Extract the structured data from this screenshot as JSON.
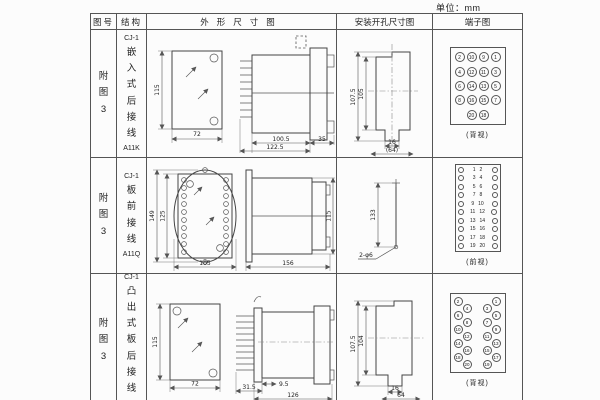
{
  "unit_label": "单位：mm",
  "table_header": {
    "fig": "图号",
    "struct": "结构",
    "outline": "外形尺寸图",
    "install": "安装开孔尺寸图",
    "terminal": "端子图"
  },
  "rows": [
    {
      "fig_label": "附图3",
      "model": "CJ-1",
      "mount_type": "嵌入式后接线",
      "code": "A11K",
      "outline": {
        "front_height": "115",
        "front_width": "72",
        "depth_body": "100.5",
        "depth_total": "122.5",
        "flange": "35"
      },
      "install": {
        "height_outer": "107.5",
        "height_inner": "105",
        "notch_width": "16",
        "width_ref": "(64)"
      },
      "terminal": {
        "type": "grid",
        "view": "(背视)",
        "grid": [
          [
            "2",
            "10",
            "9",
            "1"
          ],
          [
            "4",
            "12",
            "11",
            "3"
          ],
          [
            "6",
            "14",
            "13",
            "5"
          ],
          [
            "8",
            "16",
            "15",
            "7"
          ],
          [
            "20",
            "18"
          ]
        ]
      }
    },
    {
      "fig_label": "附图3",
      "model": "CJ-1",
      "mount_type": "板前接线",
      "code": "A11Q",
      "outline": {
        "front_height": "149",
        "inner_height": "125",
        "front_width": "105",
        "depth_total": "156",
        "side_height": "115"
      },
      "install": {
        "hole_spacing": "133",
        "hole_spec": "2-φ6"
      },
      "terminal": {
        "type": "pairs",
        "view": "(前视)",
        "pairs": [
          [
            "1",
            "2"
          ],
          [
            "3",
            "4"
          ],
          [
            "5",
            "6"
          ],
          [
            "7",
            "8"
          ],
          [
            "9",
            "10"
          ],
          [
            "11",
            "12"
          ],
          [
            "13",
            "14"
          ],
          [
            "15",
            "16"
          ],
          [
            "17",
            "18"
          ],
          [
            "19",
            "20"
          ]
        ]
      }
    },
    {
      "fig_label": "附图3",
      "model": "CJ-1",
      "mount_type": "凸出式板后接线",
      "code": "A11H",
      "outline": {
        "front_height": "115",
        "front_width": "72",
        "pin_len": "31.5",
        "gap": "9.5",
        "depth_total": "126"
      },
      "install": {
        "height_outer": "107.5",
        "height_inner": "104",
        "notch_width": "16",
        "width_ref": "64"
      },
      "terminal": {
        "type": "zigzag",
        "view": "(背视)",
        "left": [
          "2",
          "4",
          "6",
          "8",
          "10",
          "12",
          "14",
          "16",
          "18",
          "20"
        ],
        "right": [
          "1",
          "3",
          "5",
          "7",
          "9",
          "11",
          "13",
          "15",
          "17",
          "19"
        ]
      }
    }
  ]
}
